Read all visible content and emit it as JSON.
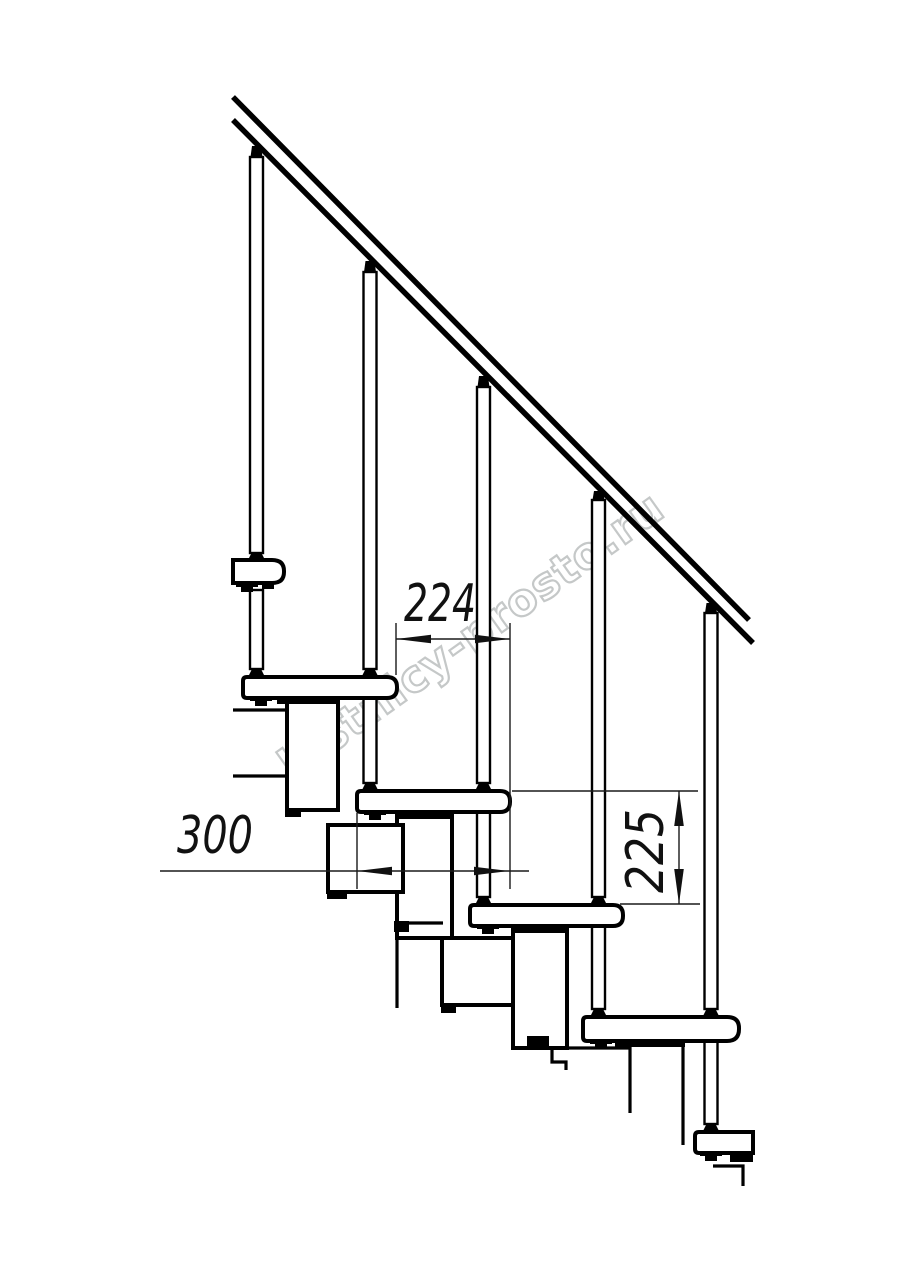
{
  "page": {
    "background": "#ffffff",
    "description": "Technical side-view line drawing of a modular staircase with handrail, five balusters, treads on stacked support modules, and dimension callouts"
  },
  "watermark": {
    "text": "lestnicy-prosto.ru",
    "color": "#c5c8c8"
  },
  "dimensions": {
    "step_run": {
      "label": "224"
    },
    "tread_depth": {
      "label": "300"
    },
    "step_rise": {
      "label": "225"
    }
  },
  "drawing": {
    "line_color": "#000000",
    "baluster_count": 5,
    "tread_count": 5
  }
}
